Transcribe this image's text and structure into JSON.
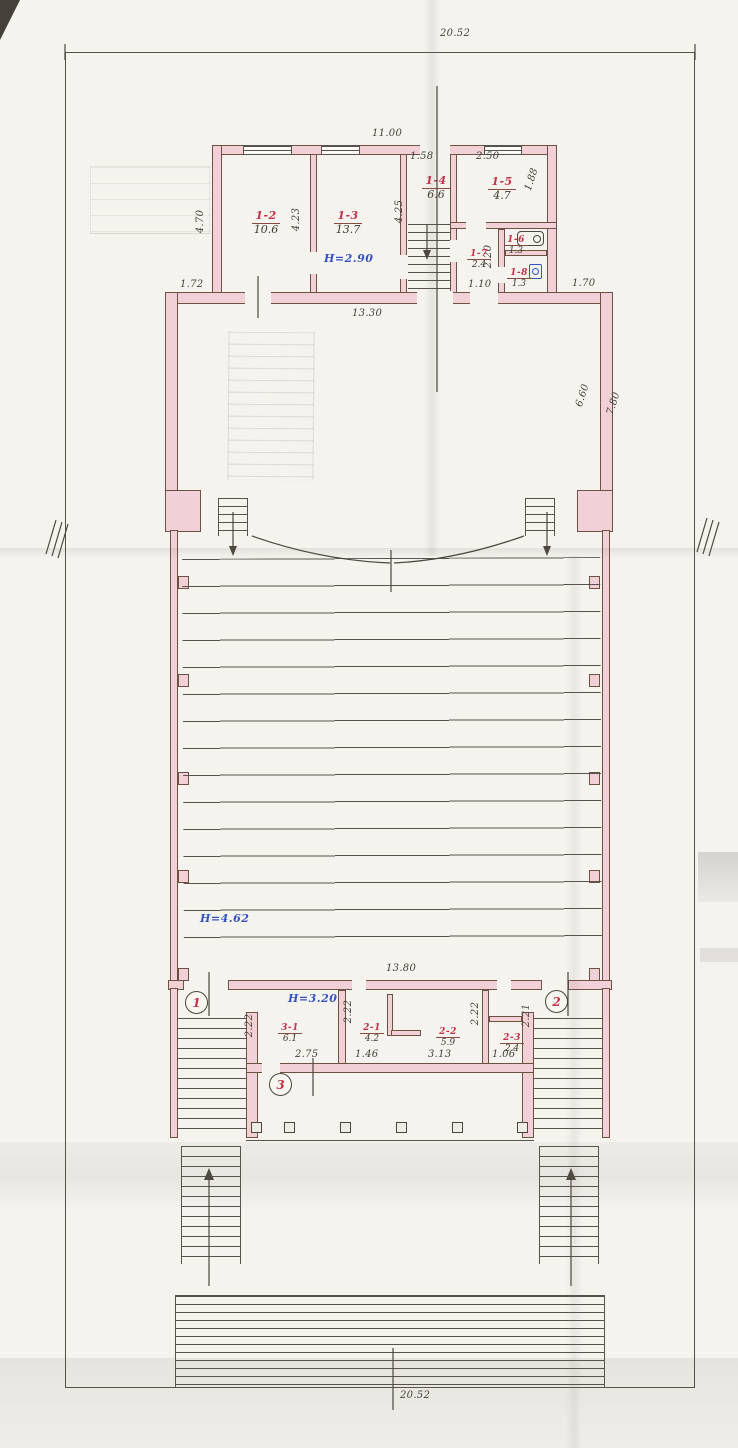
{
  "drawing": {
    "site": {
      "dim_top": "20.52",
      "dim_bottom": "20.52"
    },
    "upper_block": {
      "dim_width": "11.00",
      "dim_left": "4.70",
      "dim_r12_depth": "4.23",
      "dim_stair_depth": "4.25",
      "dim_r14_width": "1.58",
      "dim_r15_width": "2.50",
      "dim_r15_depth": "1.88",
      "dim_r17_depth": "2.20",
      "dim_r18_width": "1.10",
      "dim_out_left": "1.72",
      "dim_out_right": "1.70",
      "height_note": "Н=2.90",
      "rooms": {
        "r1_2": {
          "num": "1-2",
          "area": "10.6"
        },
        "r1_3": {
          "num": "1-3",
          "area": "13.7"
        },
        "r1_4": {
          "num": "1-4",
          "area": "6.6"
        },
        "r1_5": {
          "num": "1-5",
          "area": "4.7"
        },
        "r1_6": {
          "num": "1-6",
          "area": "1.3"
        },
        "r1_7": {
          "num": "1-7",
          "area": "2.4"
        },
        "r1_8": {
          "num": "1-8",
          "area": "1.3"
        }
      }
    },
    "hall": {
      "dim_top": "13.30",
      "dim_right_inner": "6.60",
      "dim_right_outer": "7.80",
      "height_note": "Н=4.62",
      "dim_bottom": "13.80"
    },
    "lower_block": {
      "height_note": "Н=3.20",
      "rooms": {
        "r3_1": {
          "num": "3-1",
          "area": "6.1"
        },
        "r2_1": {
          "num": "2-1",
          "area": "4.2"
        },
        "r2_2": {
          "num": "2-2",
          "area": "5.9"
        },
        "r2_3": {
          "num": "2-3",
          "area": "2.4"
        }
      },
      "dims": {
        "r3_1_depth": "2.22",
        "r3_1_width": "2.75",
        "r2_1_depth": "2.22",
        "r2_1_width": "1.46",
        "r2_2_width": "3.13",
        "r2_2_depth": "2.22",
        "r2_3_depth": "2.21",
        "r2_3_width": "1.06"
      },
      "entrances": {
        "e1": "1",
        "e2": "2",
        "e3": "3"
      }
    },
    "colors": {
      "wall_fill": "#f1d1d6",
      "room_label_red": "#c5314a",
      "height_note_blue": "#3353c4",
      "ink": "#57524b"
    }
  }
}
